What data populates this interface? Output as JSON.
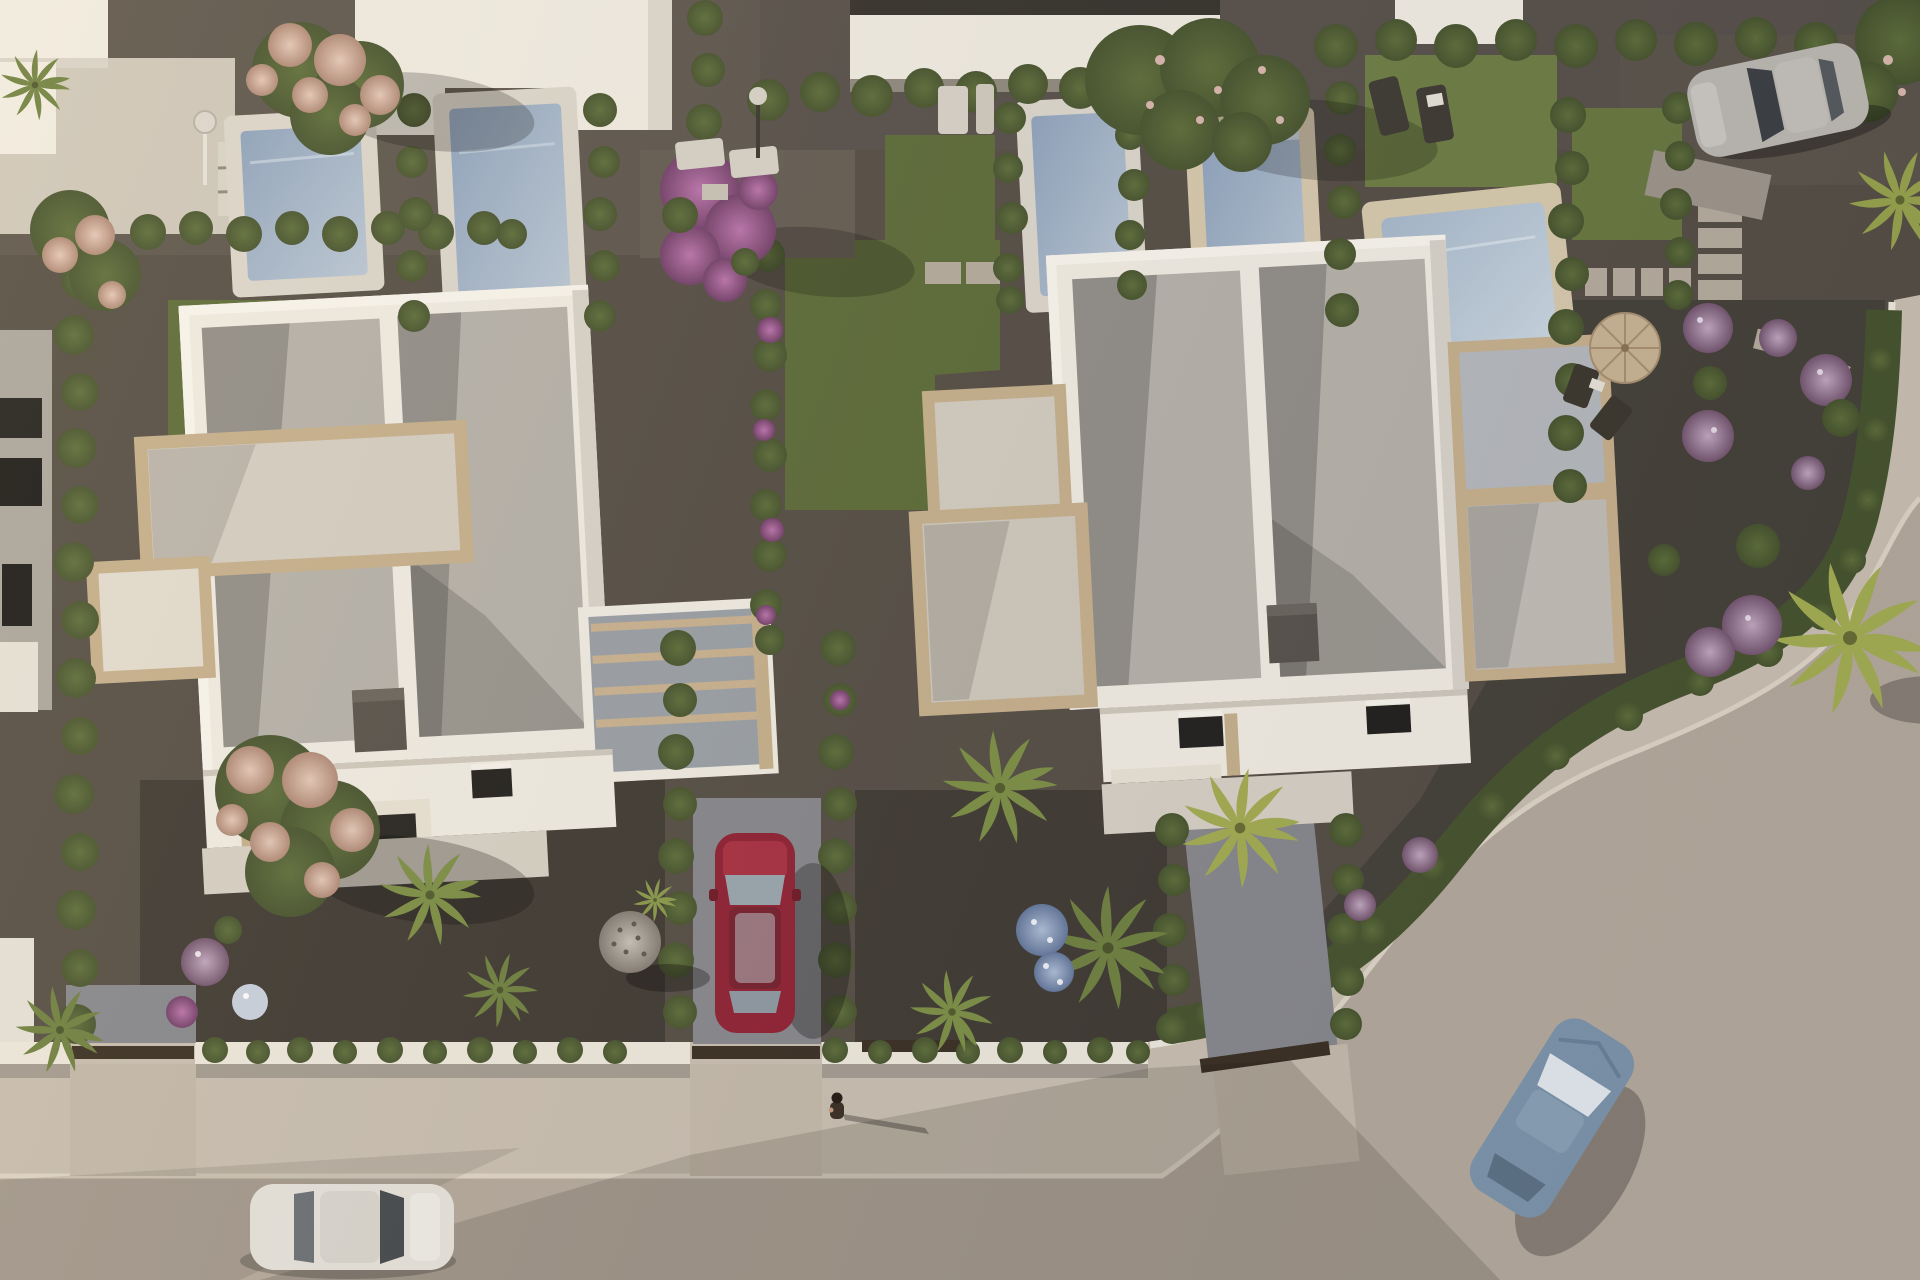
{
  "meta": {
    "title": "Aerial 3D architectural render — twin white villas with private pools",
    "view": "top-down aerial, late-afternoon sun from the left casting long shadows to the right",
    "style": "photoreal CGI of a Mediterranean residential development"
  },
  "palette": {
    "gravel_base": "#554e45",
    "gravel_dark": "#3f3a33",
    "gravel_mid": "#4a443c",
    "gravel_light": "#5d564d",
    "grass": "#5c6b38",
    "grass_bright": "#6e7e44",
    "hedge_dark": "#47542e",
    "hedge_light": "#5d6e3a",
    "road": "#b4a99c",
    "sidewalk": "#c9bfb1",
    "curb": "#ded5c6",
    "fence_white": "#eee9dd",
    "wall_white": "#f1ede3",
    "wall_shaded": "#d9d4ca",
    "roof_gravel": "#b6b2aa",
    "stone_tan": "#c6b08c",
    "terrace_floor": "#d7d1c5",
    "glass_gray": "#9aa0a6",
    "pool_coping": "#dcd7cc",
    "pool_coping_beige": "#d7caad",
    "pool_water": "#8ea3bd",
    "pool_water_light": "#bac8d6",
    "window_dark": "#22211e",
    "drive_gray": "#87888d",
    "gate_brown": "#3a2f23",
    "car_red": "#8f2133",
    "car_white": "#e6e3dc",
    "car_blue": "#7d95ab",
    "car_silver": "#bcb8b1",
    "tree_pink": "#d9b6a5",
    "tree_purple": "#a8649b",
    "flower_purple": "#b498b1",
    "flower_blue": "#93a9c8",
    "palm_green": "#6f8140",
    "palm_yellow": "#a3ad52",
    "ball_gray": "#c9c2b9"
  },
  "scene": {
    "objects": [
      {
        "name": "left-villa",
        "desc": "white flat-roof villa, two gravel roof panels, chimney, tan stone terraces, sunlit south facade"
      },
      {
        "name": "right-villa",
        "desc": "twin white villa with gravel roof, chimney, stone terraces and side annex"
      },
      {
        "name": "pools",
        "desc": "five blue private pools with pale coping in the back gardens"
      },
      {
        "name": "red-car",
        "desc": "dark red car parked top-down in hedge-lined driveway between villas"
      },
      {
        "name": "white-car",
        "desc": "white car driving on the street, bottom left"
      },
      {
        "name": "blue-car",
        "desc": "steel-blue car on the curved street, bottom right"
      },
      {
        "name": "silver-car",
        "desc": "silver car parked by the hedges, top right"
      },
      {
        "name": "pedestrian",
        "desc": "tiny person on the sidewalk casting a long shadow"
      },
      {
        "name": "street",
        "desc": "beige asphalt road with light sidewalk curving around the rounded garden corner"
      },
      {
        "name": "vegetation",
        "desc": "cypress hedges, pink blossom trees, purple bougainvillea, fan palms, lilac flower shrubs"
      },
      {
        "name": "decor",
        "desc": "round straw parasol with chairs, sun loungers, gravel sphere, stepping-stone paths, garden showers"
      }
    ]
  }
}
